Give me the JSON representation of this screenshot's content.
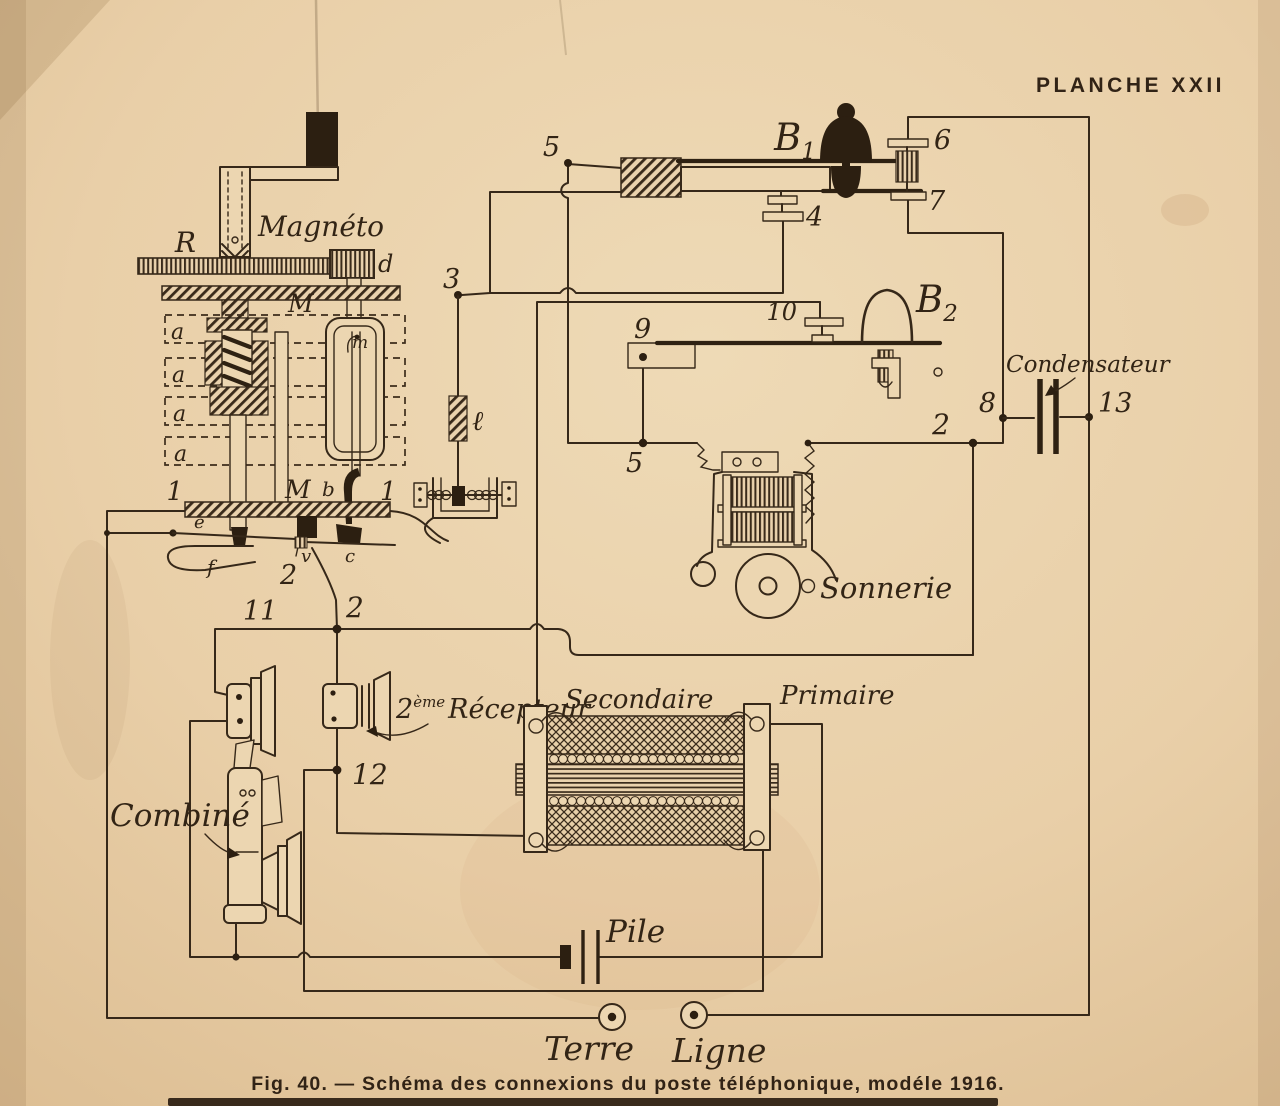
{
  "page": {
    "plate_header": "PLANCHE XXII",
    "caption": "Fig. 40. — Schéma des connexions du poste téléphonique, modéle 1916."
  },
  "colors": {
    "paper": "#e9cfa8",
    "ink": "#362819"
  },
  "labels": {
    "magneto": "Magnéto",
    "r": "R",
    "m": "M",
    "d": "d",
    "a": "a",
    "m_small": "m",
    "b_small": "b",
    "l_script": "ℓ",
    "n1": "1",
    "n2": "2",
    "n3": "3",
    "n4": "4",
    "n5": "5",
    "n6": "6",
    "n7": "7",
    "n8": "8",
    "n9": "9",
    "n10": "10",
    "n11": "11",
    "n12": "12",
    "n13": "13",
    "b_base": "B",
    "b1_sub": "1",
    "b2_sub": "2",
    "e": "e",
    "f": "f",
    "v": "v",
    "c": "c",
    "condensateur": "Condensateur",
    "sonnerie": "Sonnerie",
    "recepteur_num": "2",
    "recepteur_sup": "ème",
    "recepteur": "Récepteur",
    "combine": "Combiné",
    "secondaire": "Secondaire",
    "primaire": "Primaire",
    "pile": "Pile",
    "terre": "Terre",
    "ligne": "Ligne"
  }
}
